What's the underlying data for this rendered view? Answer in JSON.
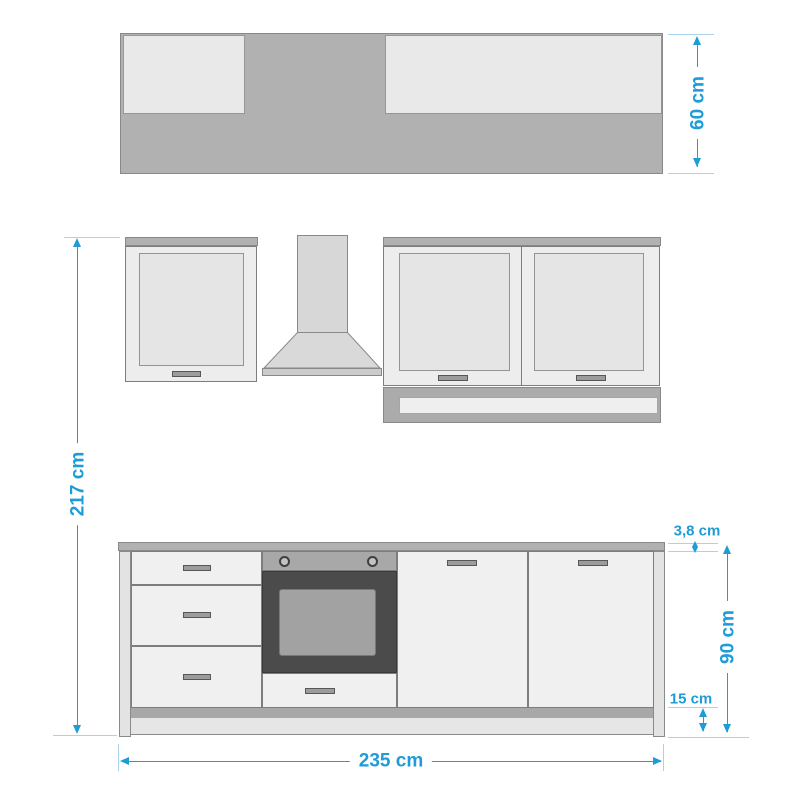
{
  "colors": {
    "accent": "#1e9cd8",
    "ext": "#a8d4ea",
    "grayMid": "#b1b1b1",
    "lightPanel": "#e9e9e9",
    "front": "#f0f0f0",
    "ovenDark": "#4b4b4b"
  },
  "dimensions": {
    "depth": {
      "label": "60 cm"
    },
    "total_height": {
      "label": "217 cm"
    },
    "worktop_thickness": {
      "label": "3,8 cm"
    },
    "base_height": {
      "label": "90 cm"
    },
    "plinth_height": {
      "label": "15 cm"
    },
    "total_width": {
      "label": "235 cm"
    }
  }
}
